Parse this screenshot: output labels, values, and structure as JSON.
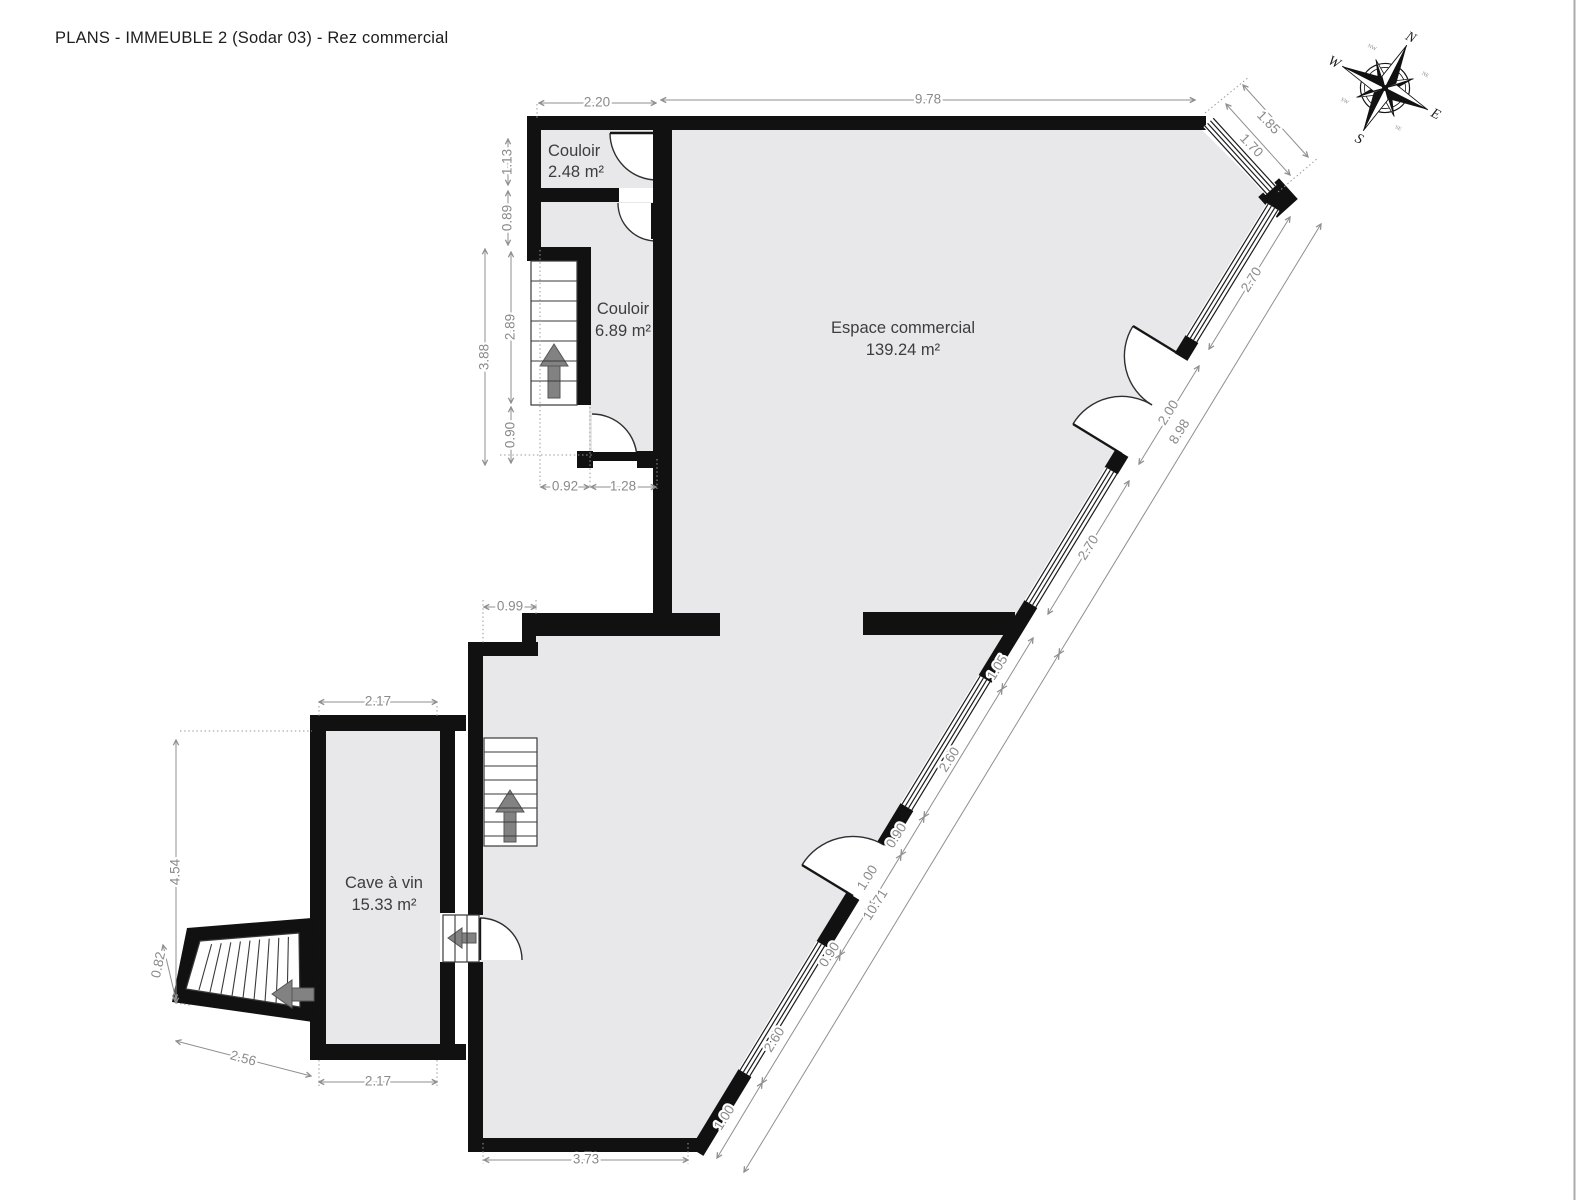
{
  "title": "PLANS - IMMEUBLE 2 (Sodar 03) - Rez commercial",
  "rooms": [
    {
      "name": "Couloir",
      "area": "2.48 m²"
    },
    {
      "name": "Couloir",
      "area": "6.89 m²"
    },
    {
      "name": "Espace commercial",
      "area": "139.24 m²"
    },
    {
      "name": "Cave à vin",
      "area": "15.33 m²"
    }
  ],
  "compass": {
    "north": "N",
    "east": "E",
    "south": "S",
    "west": "W",
    "northeast": "NE",
    "southeast": "SE",
    "southwest": "SW",
    "northwest": "NW"
  },
  "dimensions": [
    {
      "value": "2.20",
      "x": 597,
      "y": 103,
      "rot": 0
    },
    {
      "value": "9.78",
      "x": 928,
      "y": 100,
      "rot": 0
    },
    {
      "value": "1.13",
      "x": 508,
      "y": 162,
      "rot": -90
    },
    {
      "value": "0.89",
      "x": 508,
      "y": 218,
      "rot": -90
    },
    {
      "value": "3.88",
      "x": 485,
      "y": 357,
      "rot": -90
    },
    {
      "value": "2.89",
      "x": 511,
      "y": 327,
      "rot": -90
    },
    {
      "value": "0.90",
      "x": 511,
      "y": 435,
      "rot": -90
    },
    {
      "value": "0.92",
      "x": 565,
      "y": 487,
      "rot": 0
    },
    {
      "value": "1.28",
      "x": 623,
      "y": 487,
      "rot": 0
    },
    {
      "value": "0.99",
      "x": 510,
      "y": 607,
      "rot": 0
    },
    {
      "value": "2.17",
      "x": 378,
      "y": 702,
      "rot": 0
    },
    {
      "value": "4.54",
      "x": 176,
      "y": 872,
      "rot": -90
    },
    {
      "value": "0.82",
      "x": 159,
      "y": 965,
      "rot": -78
    },
    {
      "value": "2.56",
      "x": 243,
      "y": 1059,
      "rot": 15
    },
    {
      "value": "2.17",
      "x": 378,
      "y": 1082,
      "rot": 0
    },
    {
      "value": "3.73",
      "x": 586,
      "y": 1160,
      "rot": 0
    },
    {
      "value": "1.85",
      "x": 1268,
      "y": 123,
      "rot": 46
    },
    {
      "value": "1.70",
      "x": 1251,
      "y": 146,
      "rot": 46
    },
    {
      "value": "2.70",
      "x": 1252,
      "y": 280,
      "rot": -58
    },
    {
      "value": "2.00",
      "x": 1169,
      "y": 413,
      "rot": -58
    },
    {
      "value": "2.70",
      "x": 1089,
      "y": 548,
      "rot": -58
    },
    {
      "value": "1.05",
      "x": 998,
      "y": 668,
      "rot": -58
    },
    {
      "value": "2.60",
      "x": 950,
      "y": 760,
      "rot": -58
    },
    {
      "value": "0.90",
      "x": 897,
      "y": 836,
      "rot": -58
    },
    {
      "value": "1.00",
      "x": 868,
      "y": 878,
      "rot": -58
    },
    {
      "value": "0.90",
      "x": 830,
      "y": 955,
      "rot": -58
    },
    {
      "value": "2.60",
      "x": 775,
      "y": 1040,
      "rot": -58
    },
    {
      "value": "1.00",
      "x": 725,
      "y": 1118,
      "rot": -58
    },
    {
      "value": "8.98",
      "x": 1180,
      "y": 432,
      "rot": -58
    },
    {
      "value": "10.71",
      "x": 876,
      "y": 905,
      "rot": -58
    }
  ],
  "colors": {
    "wall": "#111111",
    "floor": "#e8e8ea",
    "dimension": "#8a8a8a",
    "label": "#3d3d3d"
  }
}
